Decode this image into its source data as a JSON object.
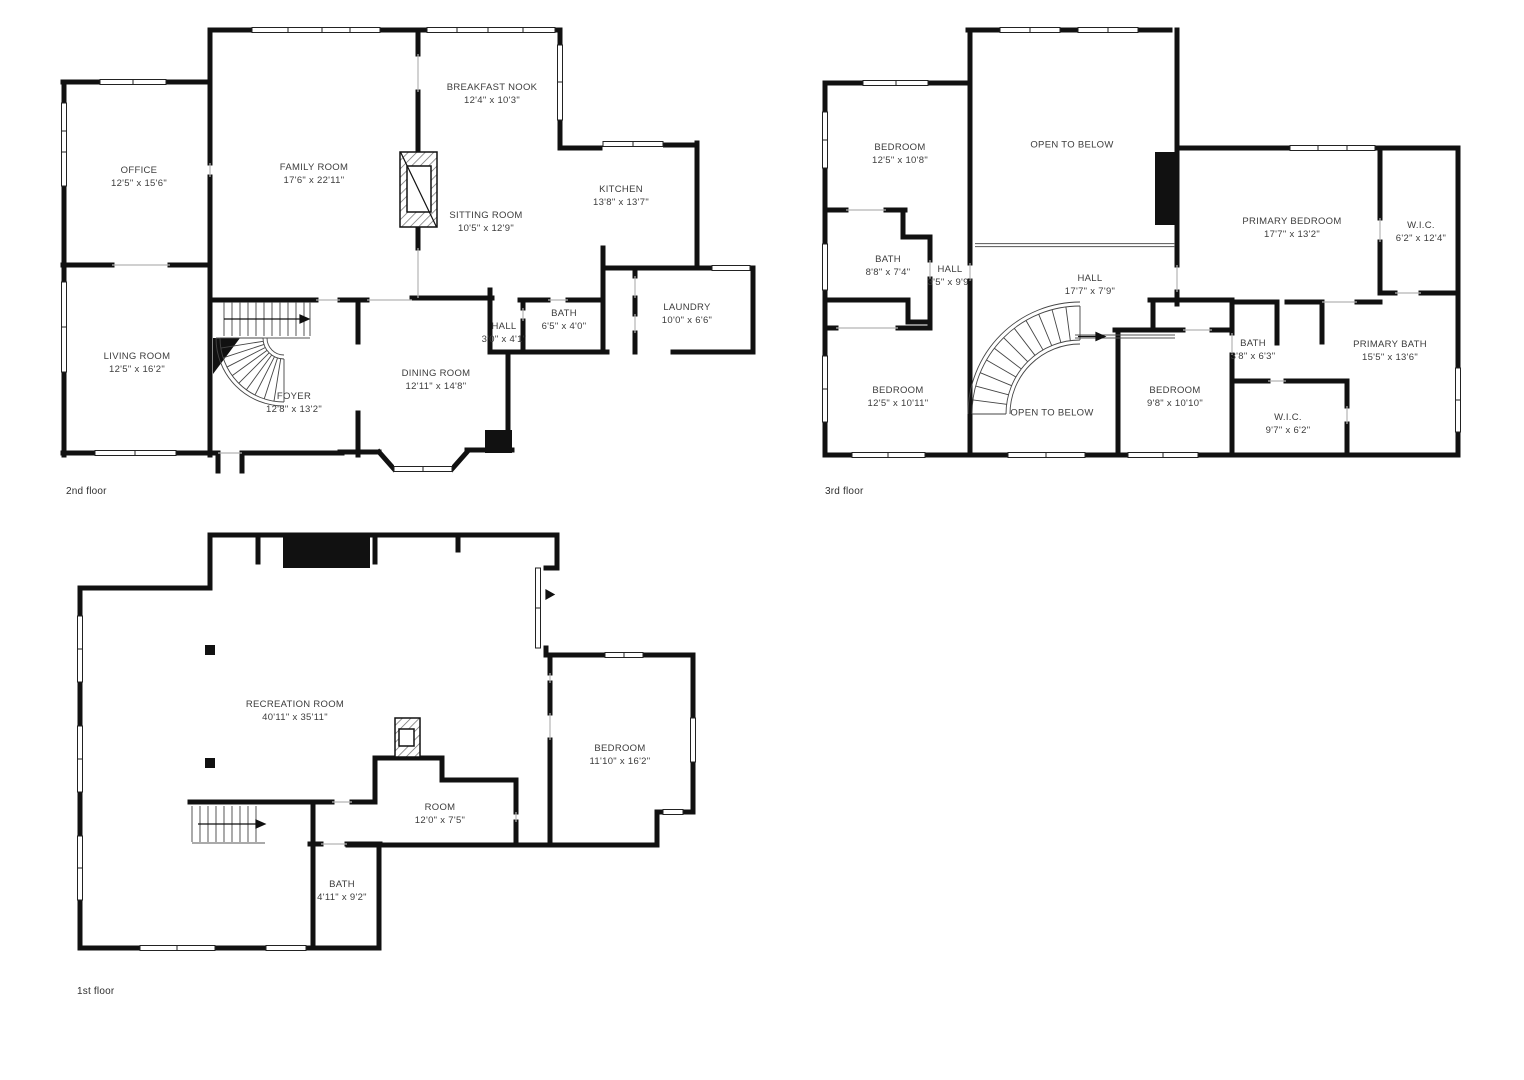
{
  "palette": {
    "background": "#ffffff",
    "walls": "#111111",
    "text": "#3c3c3c"
  },
  "floors": [
    {
      "label": "2nd floor",
      "rooms": [
        {
          "name": "OFFICE",
          "dims": "12'5\" x 15'6\""
        },
        {
          "name": "FAMILY ROOM",
          "dims": "17'6\" x 22'11\""
        },
        {
          "name": "BREAKFAST NOOK",
          "dims": "12'4\" x 10'3\""
        },
        {
          "name": "KITCHEN",
          "dims": "13'8\" x 13'7\""
        },
        {
          "name": "SITTING ROOM",
          "dims": "10'5\" x 12'9\""
        },
        {
          "name": "LIVING ROOM",
          "dims": "12'5\" x 16'2\""
        },
        {
          "name": "FOYER",
          "dims": "12'8\" x 13'2\""
        },
        {
          "name": "DINING ROOM",
          "dims": "12'11\" x 14'8\""
        },
        {
          "name": "HALL",
          "dims": "3'0\" x 4'1\""
        },
        {
          "name": "BATH",
          "dims": "6'5\" x 4'0\""
        },
        {
          "name": "LAUNDRY",
          "dims": "10'0\" x 6'6\""
        }
      ]
    },
    {
      "label": "3rd floor",
      "rooms": [
        {
          "name": "BEDROOM",
          "dims": "12'5\" x 10'8\""
        },
        {
          "name": "OPEN TO BELOW",
          "dims": ""
        },
        {
          "name": "PRIMARY BEDROOM",
          "dims": "17'7\" x 13'2\""
        },
        {
          "name": "W.I.C.",
          "dims": "6'2\" x 12'4\""
        },
        {
          "name": "BATH",
          "dims": "8'8\" x 7'4\""
        },
        {
          "name": "HALL",
          "dims": "3'5\" x 9'9\""
        },
        {
          "name": "HALL",
          "dims": "17'7\" x 7'9\""
        },
        {
          "name": "BEDROOM",
          "dims": "12'5\" x 10'11\""
        },
        {
          "name": "OPEN TO BELOW",
          "dims": ""
        },
        {
          "name": "BEDROOM",
          "dims": "9'8\" x 10'10\""
        },
        {
          "name": "BATH",
          "dims": "3'8\" x 6'3\""
        },
        {
          "name": "PRIMARY BATH",
          "dims": "15'5\" x 13'6\""
        },
        {
          "name": "W.I.C.",
          "dims": "9'7\" x 6'2\""
        }
      ]
    },
    {
      "label": "1st floor",
      "rooms": [
        {
          "name": "RECREATION ROOM",
          "dims": "40'11\" x 35'11\""
        },
        {
          "name": "BEDROOM",
          "dims": "11'10\" x 16'2\""
        },
        {
          "name": "ROOM",
          "dims": "12'0\" x 7'5\""
        },
        {
          "name": "BATH",
          "dims": "4'11\" x 9'2\""
        }
      ]
    }
  ]
}
